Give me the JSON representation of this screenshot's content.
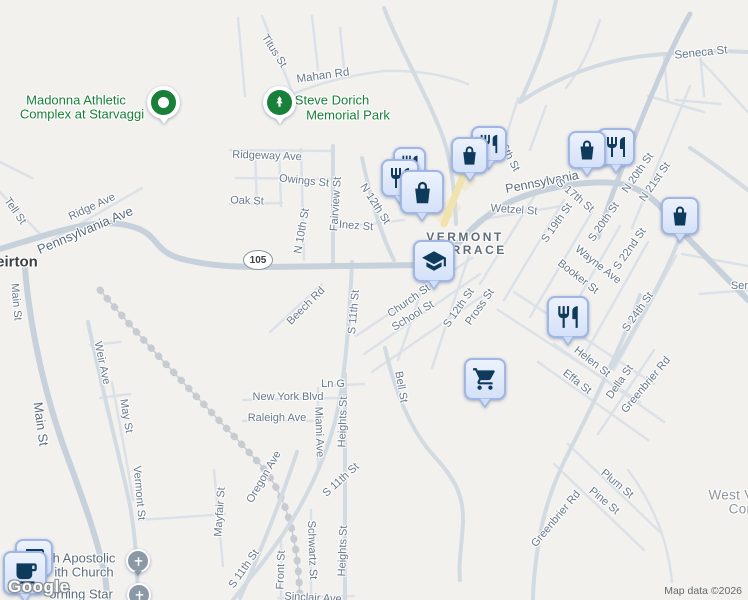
{
  "map": {
    "route_shield": {
      "text": "105"
    },
    "colors": {
      "background": "#f2f1ee",
      "road": "#c7d1db",
      "road_minor": "#dce1e8",
      "road_highlight_yellow": "#f0e3ae",
      "pin_fill": "#d9e5f9",
      "pin_border": "#9fb6e6",
      "pin_glyph": "#0e3a5c",
      "poi_green": "#188038",
      "church_gray": "#8b98a6"
    },
    "labels": [
      {
        "t": "Seneca St",
        "x": 701,
        "y": 53,
        "r": -6,
        "s": 11.5
      },
      {
        "t": "Titus St",
        "x": 274,
        "y": 51,
        "r": 57
      },
      {
        "t": "Mahan Rd",
        "x": 323,
        "y": 76,
        "r": -8,
        "s": 11.5
      },
      {
        "t": "Ridgeway Ave",
        "x": 267,
        "y": 156,
        "r": 2
      },
      {
        "t": "Owings St",
        "x": 304,
        "y": 181,
        "r": 6
      },
      {
        "t": "Oak St",
        "x": 247,
        "y": 201,
        "r": 2
      },
      {
        "t": "Fairview St",
        "x": 336,
        "y": 204,
        "r": -86
      },
      {
        "t": "N 12th St",
        "x": 375,
        "y": 204,
        "r": 57
      },
      {
        "t": "Inez St",
        "x": 356,
        "y": 226,
        "r": 4
      },
      {
        "t": "N 10th St",
        "x": 302,
        "y": 231,
        "r": -80
      },
      {
        "t": "Tell St",
        "x": 15,
        "y": 211,
        "r": 55
      },
      {
        "t": "Ridge Ave",
        "x": 92,
        "y": 207,
        "r": -25
      },
      {
        "t": "Pennsylvania Ave",
        "x": 85,
        "y": 230,
        "r": -23,
        "s": 13,
        "c": "street-lg"
      },
      {
        "t": "Main St",
        "x": 16,
        "y": 302,
        "r": 85
      },
      {
        "t": "Main St",
        "x": 41,
        "y": 424,
        "r": 82,
        "s": 13,
        "c": "street-lg"
      },
      {
        "t": "Pennsylvania",
        "x": 542,
        "y": 182,
        "r": -11,
        "s": 12.5,
        "c": "street-lg"
      },
      {
        "t": "Wetzel St",
        "x": 514,
        "y": 210,
        "r": 4
      },
      {
        "t": "6th St",
        "x": 510,
        "y": 158,
        "r": 62
      },
      {
        "t": "S 17th St",
        "x": 575,
        "y": 196,
        "r": 40
      },
      {
        "t": "S 19th St",
        "x": 557,
        "y": 223,
        "r": -55
      },
      {
        "t": "S 20th St",
        "x": 604,
        "y": 222,
        "r": -55
      },
      {
        "t": "N 20th St",
        "x": 638,
        "y": 173,
        "r": -55
      },
      {
        "t": "N 21st St",
        "x": 655,
        "y": 182,
        "r": -55
      },
      {
        "t": "S 22nd St",
        "x": 630,
        "y": 249,
        "r": -55
      },
      {
        "t": "Wayne Ave",
        "x": 598,
        "y": 265,
        "r": 38
      },
      {
        "t": "Booker St",
        "x": 578,
        "y": 277,
        "r": 38
      },
      {
        "t": "S 24th St",
        "x": 638,
        "y": 312,
        "r": -55
      },
      {
        "t": "Serm",
        "x": 744,
        "y": 286,
        "r": 0
      },
      {
        "t": "Helen St",
        "x": 592,
        "y": 362,
        "r": 38
      },
      {
        "t": "Effa St",
        "x": 577,
        "y": 382,
        "r": 38
      },
      {
        "t": "Della St",
        "x": 620,
        "y": 382,
        "r": -55
      },
      {
        "t": "Greenbrier Rd",
        "x": 646,
        "y": 385,
        "r": -50
      },
      {
        "t": "Greenbrier Rd",
        "x": 556,
        "y": 519,
        "r": -50
      },
      {
        "t": "Plum St",
        "x": 617,
        "y": 484,
        "r": 40
      },
      {
        "t": "Pine St",
        "x": 604,
        "y": 501,
        "r": 40
      },
      {
        "t": "Church St",
        "x": 409,
        "y": 301,
        "r": -35
      },
      {
        "t": "School St",
        "x": 413,
        "y": 316,
        "r": -32
      },
      {
        "t": "S 12th St",
        "x": 459,
        "y": 308,
        "r": -55
      },
      {
        "t": "Pross St",
        "x": 480,
        "y": 307,
        "r": -55
      },
      {
        "t": "S 11th St",
        "x": 354,
        "y": 312,
        "r": -85
      },
      {
        "t": "Beech Rd",
        "x": 306,
        "y": 306,
        "r": -45
      },
      {
        "t": "Bell St",
        "x": 401,
        "y": 387,
        "r": 80
      },
      {
        "t": "Ln G",
        "x": 333,
        "y": 384,
        "r": 0
      },
      {
        "t": "New York Blvd",
        "x": 288,
        "y": 397,
        "r": 0
      },
      {
        "t": "Raleigh Ave",
        "x": 277,
        "y": 418,
        "r": 0
      },
      {
        "t": "Miami Ave",
        "x": 319,
        "y": 432,
        "r": 88
      },
      {
        "t": "Heights St",
        "x": 343,
        "y": 422,
        "r": -88
      },
      {
        "t": "Oregon Ave",
        "x": 264,
        "y": 477,
        "r": -60
      },
      {
        "t": "S 11th St",
        "x": 341,
        "y": 480,
        "r": -42
      },
      {
        "t": "Weir Ave",
        "x": 102,
        "y": 363,
        "r": 78
      },
      {
        "t": "May St",
        "x": 126,
        "y": 416,
        "r": 80
      },
      {
        "t": "Vermont St",
        "x": 139,
        "y": 493,
        "r": 85
      },
      {
        "t": "Mayfair St",
        "x": 220,
        "y": 512,
        "r": -86
      },
      {
        "t": "S 11th St",
        "x": 244,
        "y": 569,
        "r": -55
      },
      {
        "t": "Front St",
        "x": 281,
        "y": 570,
        "r": -88
      },
      {
        "t": "Schwartz St",
        "x": 312,
        "y": 550,
        "r": 88
      },
      {
        "t": "Heights St",
        "x": 343,
        "y": 551,
        "r": -88
      },
      {
        "t": "Sinclair Ave",
        "x": 313,
        "y": 598,
        "r": 3
      },
      {
        "t": "eirton",
        "x": 17,
        "y": 262,
        "r": 0,
        "c": "city",
        "n": "city-label-weirton"
      },
      {
        "t": "VERMONT",
        "x": 465,
        "y": 237,
        "r": 0,
        "c": "area",
        "n": "area-label-vermont-terrace"
      },
      {
        "t": "TERRACE",
        "x": 469,
        "y": 250,
        "r": 0,
        "c": "area",
        "n": "area-label-vermont-terrace"
      },
      {
        "t": "Madonna Athletic",
        "x": 76,
        "y": 100,
        "c": "poi-green",
        "n": "poi-label-madonna-athletic-complex"
      },
      {
        "t": "Complex at Starvaggi",
        "x": 82,
        "y": 114,
        "c": "poi-green",
        "n": "poi-label-madonna-athletic-complex"
      },
      {
        "t": "Steve Dorich",
        "x": 332,
        "y": 100,
        "c": "poi-green",
        "n": "poi-label-steve-dorich-memorial-park"
      },
      {
        "t": "Memorial Park",
        "x": 348,
        "y": 115,
        "c": "poi-green",
        "n": "poi-label-steve-dorich-memorial-park"
      },
      {
        "t": "h Apostolic",
        "x": 84,
        "y": 558,
        "c": "poi-gray",
        "n": "poi-label-apostolic-church"
      },
      {
        "t": "ith Church",
        "x": 84,
        "y": 572,
        "c": "poi-gray",
        "n": "poi-label-apostolic-church"
      },
      {
        "t": "orning Star",
        "x": 81,
        "y": 594,
        "c": "poi-gray",
        "n": "poi-label-morning-star"
      },
      {
        "t": "West V",
        "x": 731,
        "y": 495,
        "c": "area-gray",
        "n": "poi-label-west-virginia"
      },
      {
        "t": "Cor",
        "x": 740,
        "y": 509,
        "c": "area-gray",
        "n": "poi-label-west-virginia"
      }
    ],
    "pins": [
      {
        "type": "restaurant",
        "x": 393,
        "y": 147,
        "w": 33
      },
      {
        "type": "restaurant",
        "x": 471,
        "y": 126,
        "w": 36
      },
      {
        "type": "shopping-bag",
        "x": 451,
        "y": 137,
        "w": 37
      },
      {
        "type": "restaurant",
        "x": 381,
        "y": 159,
        "w": 38
      },
      {
        "type": "shopping-bag",
        "x": 400,
        "y": 170,
        "w": 44
      },
      {
        "type": "restaurant",
        "x": 597,
        "y": 128,
        "w": 38
      },
      {
        "type": "shopping-bag",
        "x": 568,
        "y": 131,
        "w": 38
      },
      {
        "type": "shopping-bag",
        "x": 661,
        "y": 197,
        "w": 38
      },
      {
        "type": "school",
        "x": 413,
        "y": 240,
        "w": 42
      },
      {
        "type": "grocery-cart",
        "x": 464,
        "y": 358,
        "w": 42
      },
      {
        "type": "restaurant",
        "x": 547,
        "y": 296,
        "w": 42
      },
      {
        "type": "cafe",
        "x": 15,
        "y": 539,
        "w": 38
      },
      {
        "type": "cafe",
        "x": 3,
        "y": 551,
        "w": 44
      },
      {
        "type": "park",
        "x": 263,
        "y": 86,
        "w": 33
      },
      {
        "type": "place",
        "x": 147,
        "y": 86,
        "w": 33
      },
      {
        "type": "church",
        "x": 126,
        "y": 549,
        "w": 24
      },
      {
        "type": "church",
        "x": 127,
        "y": 583,
        "w": 24
      }
    ]
  },
  "attribution": {
    "logo": "Google",
    "map_data": "Map data ©2026"
  }
}
